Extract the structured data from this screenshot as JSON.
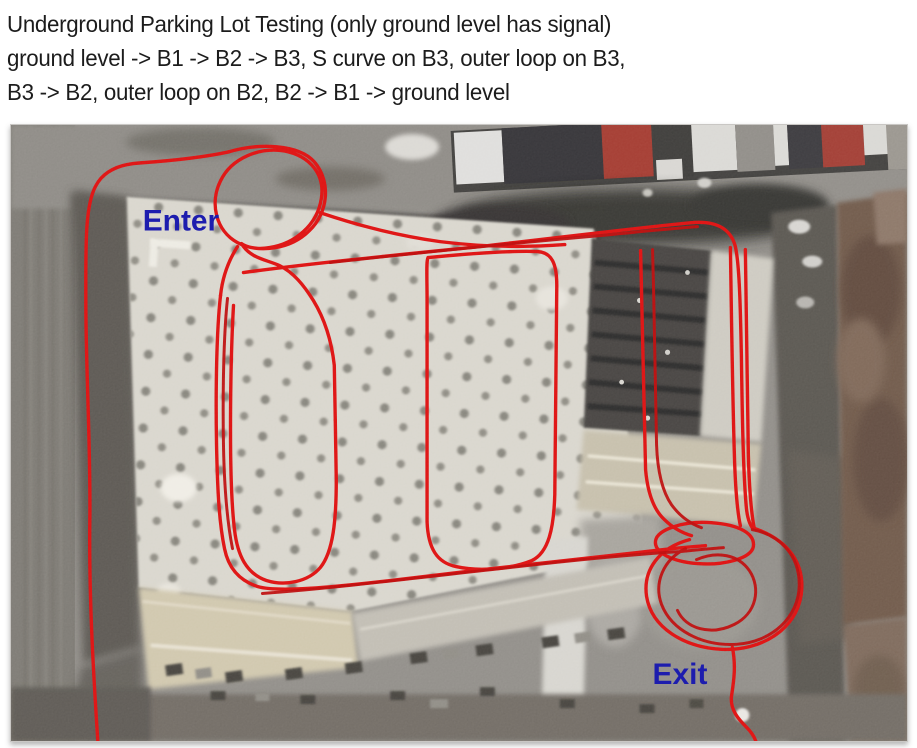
{
  "title": {
    "line1": "Underground Parking Lot Testing (only ground level has signal)",
    "line2": "ground level -> B1 -> B2 -> B3, S curve on B3, outer loop on B3,",
    "line3": "B3 -> B2, outer loop on B2, B2 -> B1 -> ground level"
  },
  "map": {
    "enter_label": "Enter",
    "exit_label": "Exit",
    "colors": {
      "track": "#dd1212",
      "track_dark": "#bc0e0e",
      "label_blue": "#1d1dae"
    }
  }
}
